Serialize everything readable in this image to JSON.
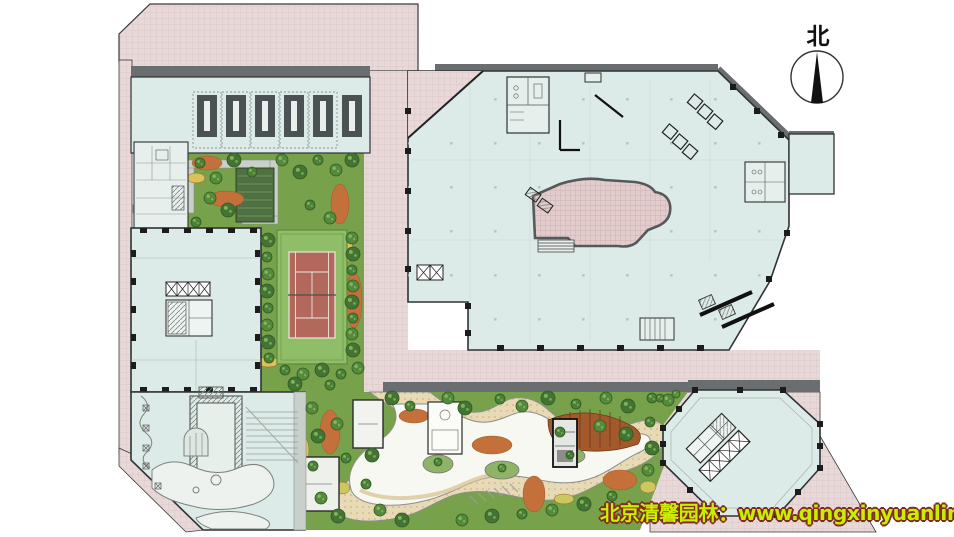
{
  "compass": {
    "label": "北"
  },
  "watermark": {
    "text": "北京清馨园林：www.qingxinyuanlin.com"
  },
  "palette": {
    "background": "#ffffff",
    "pavement_pink": "#e8d8d8",
    "pavement_line": "#d8c4c4",
    "floor_cyan": "#dcebe7",
    "wall_dark": "#5d6164",
    "lawn_green": "#77a24b",
    "tennis_court_red": "#b2695c",
    "tennis_apron_green": "#8fbd68",
    "path_tan": "#e8d9b4",
    "path_white": "#f8f8f3",
    "tree_green": "#4c8038",
    "planting_orange": "#c3703a",
    "deck_brown": "#a2592b",
    "watermark_fill": "#c9ee00",
    "watermark_outline": "#7e2c1e",
    "north_needle": "#111111"
  }
}
